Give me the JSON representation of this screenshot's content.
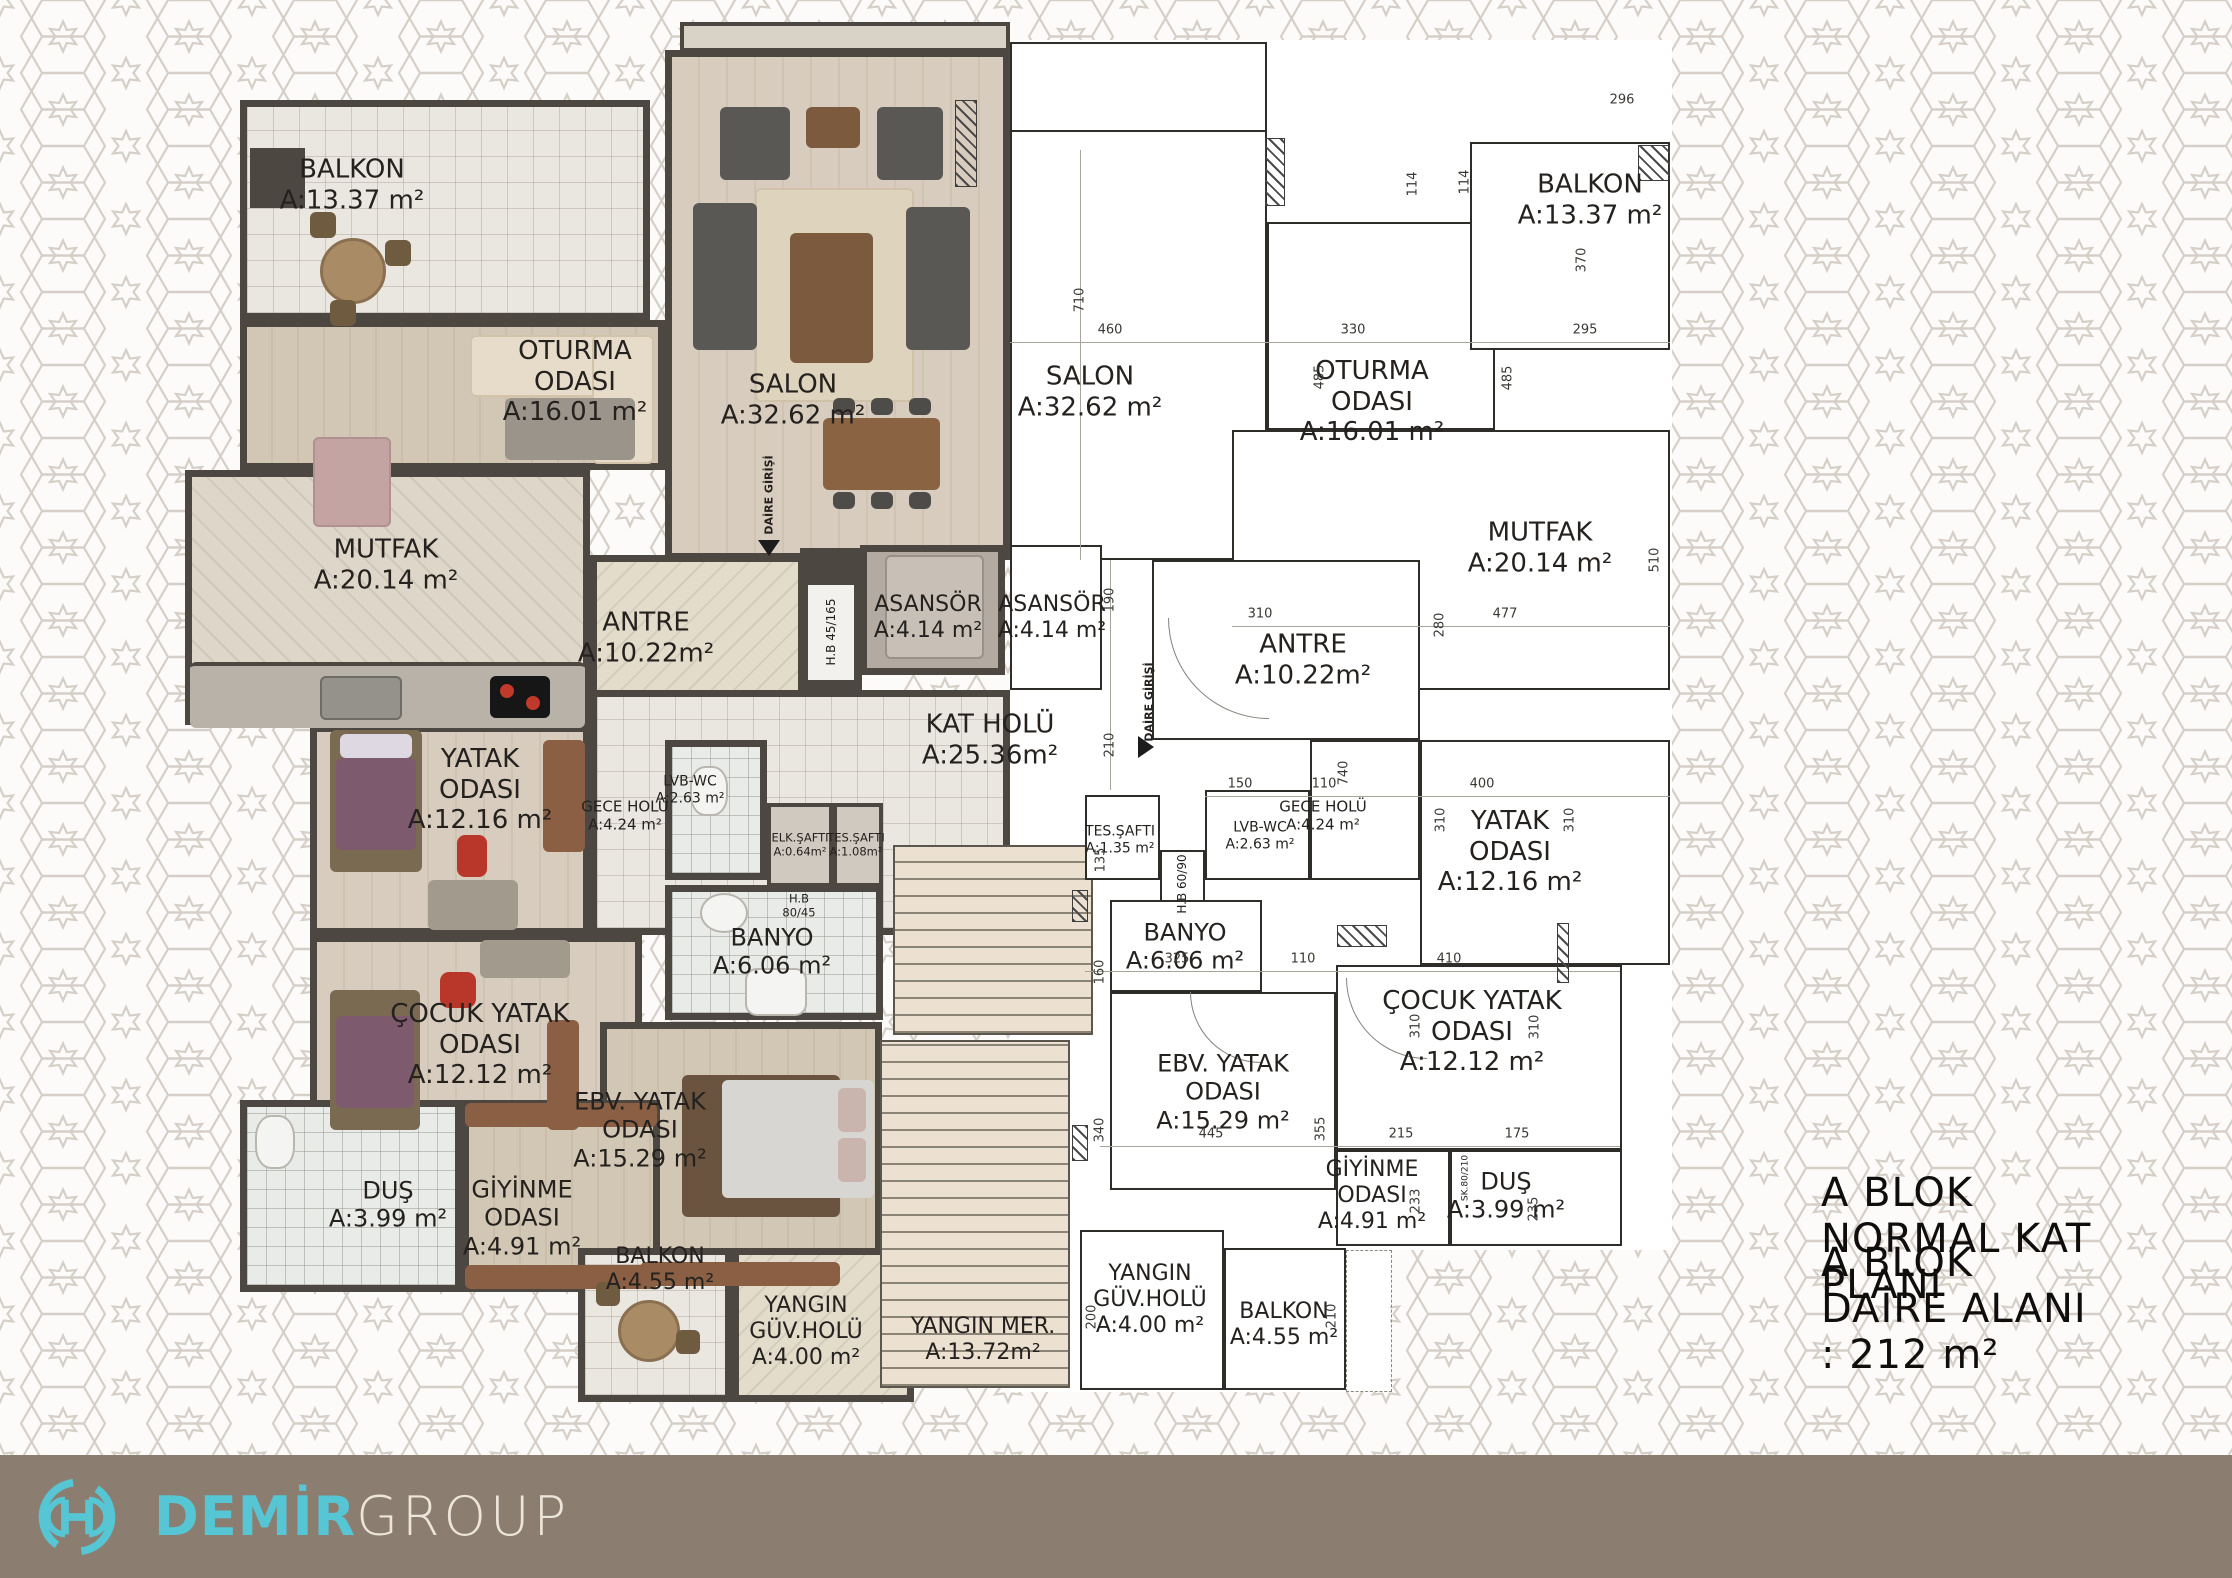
{
  "title": {
    "line1": "A BLOK NORMAL KAT PLANI",
    "line2": "A BLOK DAİRE ALANI : 212 m²"
  },
  "footer": {
    "brand_primary": "DEMİR",
    "brand_secondary": "GROUP"
  },
  "colors": {
    "accent_turquoise": "#56c5d4",
    "footer_bar": "#8b7e70",
    "brand_secondary_text": "#ede5da",
    "wall_dark": "#4c4741",
    "line_dark": "#2f2d2a",
    "pattern_line": "#d6cfc7"
  },
  "rooms_left": {
    "balkon_top": {
      "name": "BALKON",
      "area": "A:13.37 m²"
    },
    "oturma": {
      "name": "OTURMA",
      "name2": "ODASI",
      "area": "A:16.01 m²"
    },
    "salon": {
      "name": "SALON",
      "area": "A:32.62 m²"
    },
    "mutfak": {
      "name": "MUTFAK",
      "area": "A:20.14 m²"
    },
    "antre": {
      "name": "ANTRE",
      "area": "A:10.22m²"
    },
    "yatak": {
      "name": "YATAK",
      "name2": "ODASI",
      "area": "A:12.16 m²"
    },
    "gece_holu": {
      "name": "GECE HOLÜ",
      "area": "A:4.24 m²"
    },
    "lvb_wc": {
      "name": "LVB-WC",
      "area": "A:2.63 m²"
    },
    "elk_safti": {
      "name": "ELK.ŞAFTI",
      "area": "A:0.64m²"
    },
    "tes_safti": {
      "name": "TES.ŞAFTI",
      "area": "A:1.08m²"
    },
    "banyo": {
      "name": "BANYO",
      "area": "A:6.06 m²"
    },
    "cocuk": {
      "name": "ÇOCUK YATAK",
      "name2": "ODASI",
      "area": "A:12.12 m²"
    },
    "dus": {
      "name": "DUŞ",
      "area": "A:3.99 m²"
    },
    "giyinme": {
      "name": "GİYİNME",
      "name2": "ODASI",
      "area": "A:4.91 m²"
    },
    "ebv": {
      "name": "EBV. YATAK",
      "name2": "ODASI",
      "area": "A:15.29 m²"
    },
    "balkon_alt": {
      "name": "BALKON",
      "area": "A:4.55 m²"
    },
    "yangin_guv": {
      "name": "YANGIN",
      "name2": "GÜV.HOLÜ",
      "area": "A:4.00 m²"
    }
  },
  "rooms_right": {
    "salon": {
      "name": "SALON",
      "area": "A:32.62 m²"
    },
    "oturma": {
      "name": "OTURMA",
      "name2": "ODASI",
      "area": "A:16.01 m²"
    },
    "balkon_top": {
      "name": "BALKON",
      "area": "A:13.37 m²"
    },
    "mutfak": {
      "name": "MUTFAK",
      "area": "A:20.14 m²"
    },
    "antre": {
      "name": "ANTRE",
      "area": "A:10.22m²"
    },
    "gece_holu": {
      "name": "GECE HOLÜ",
      "area": "A:4.24 m²"
    },
    "lvb_wc": {
      "name": "LVB-WC",
      "area": "A:2.63 m²"
    },
    "tes_safti": {
      "name": "TES.ŞAFTI",
      "area": "A:1.35 m²"
    },
    "yatak": {
      "name": "YATAK",
      "name2": "ODASI",
      "area": "A:12.16 m²"
    },
    "banyo": {
      "name": "BANYO",
      "area": "A:6.06 m²"
    },
    "ebv": {
      "name": "EBV. YATAK",
      "name2": "ODASI",
      "area": "A:15.29 m²"
    },
    "cocuk": {
      "name": "ÇOCUK YATAK",
      "name2": "ODASI",
      "area": "A:12.12 m²"
    },
    "giyinme": {
      "name": "GİYİNME",
      "name2": "ODASI",
      "area": "A:4.91 m²"
    },
    "dus": {
      "name": "DUŞ",
      "area": "A:3.99 m²"
    },
    "yangin_guv": {
      "name": "YANGIN",
      "name2": "GÜV.HOLÜ",
      "area": "A:4.00 m²"
    },
    "balkon_alt": {
      "name": "BALKON",
      "area": "A:4.55 m²"
    }
  },
  "core": {
    "kat_holu": {
      "name": "KAT HOLÜ",
      "area": "A:25.36m²"
    },
    "asansor": {
      "name": "ASANSÖR",
      "area": "A:4.14 m²"
    },
    "yangin_mer": {
      "name": "YANGIN MER.",
      "area": "A:13.72m²"
    },
    "daire_girisi": "DAİRE GİRİŞİ",
    "hb_45165": {
      "l1": "H.B",
      "l2": "45/165"
    },
    "hb_8045": {
      "l1": "H.B",
      "l2": "80/45"
    },
    "hb_6090": "H.B 60/90",
    "sk_80210": "SK.80/210"
  },
  "dims": [
    "710",
    "460",
    "330",
    "485",
    "485",
    "114",
    "370",
    "295",
    "296",
    "190",
    "210",
    "310",
    "280",
    "477",
    "510",
    "740",
    "150",
    "110",
    "400",
    "310",
    "310",
    "135",
    "160",
    "325",
    "110",
    "410",
    "310",
    "310",
    "340",
    "445",
    "355",
    "215",
    "175",
    "233",
    "235",
    "200",
    "210",
    "114"
  ]
}
